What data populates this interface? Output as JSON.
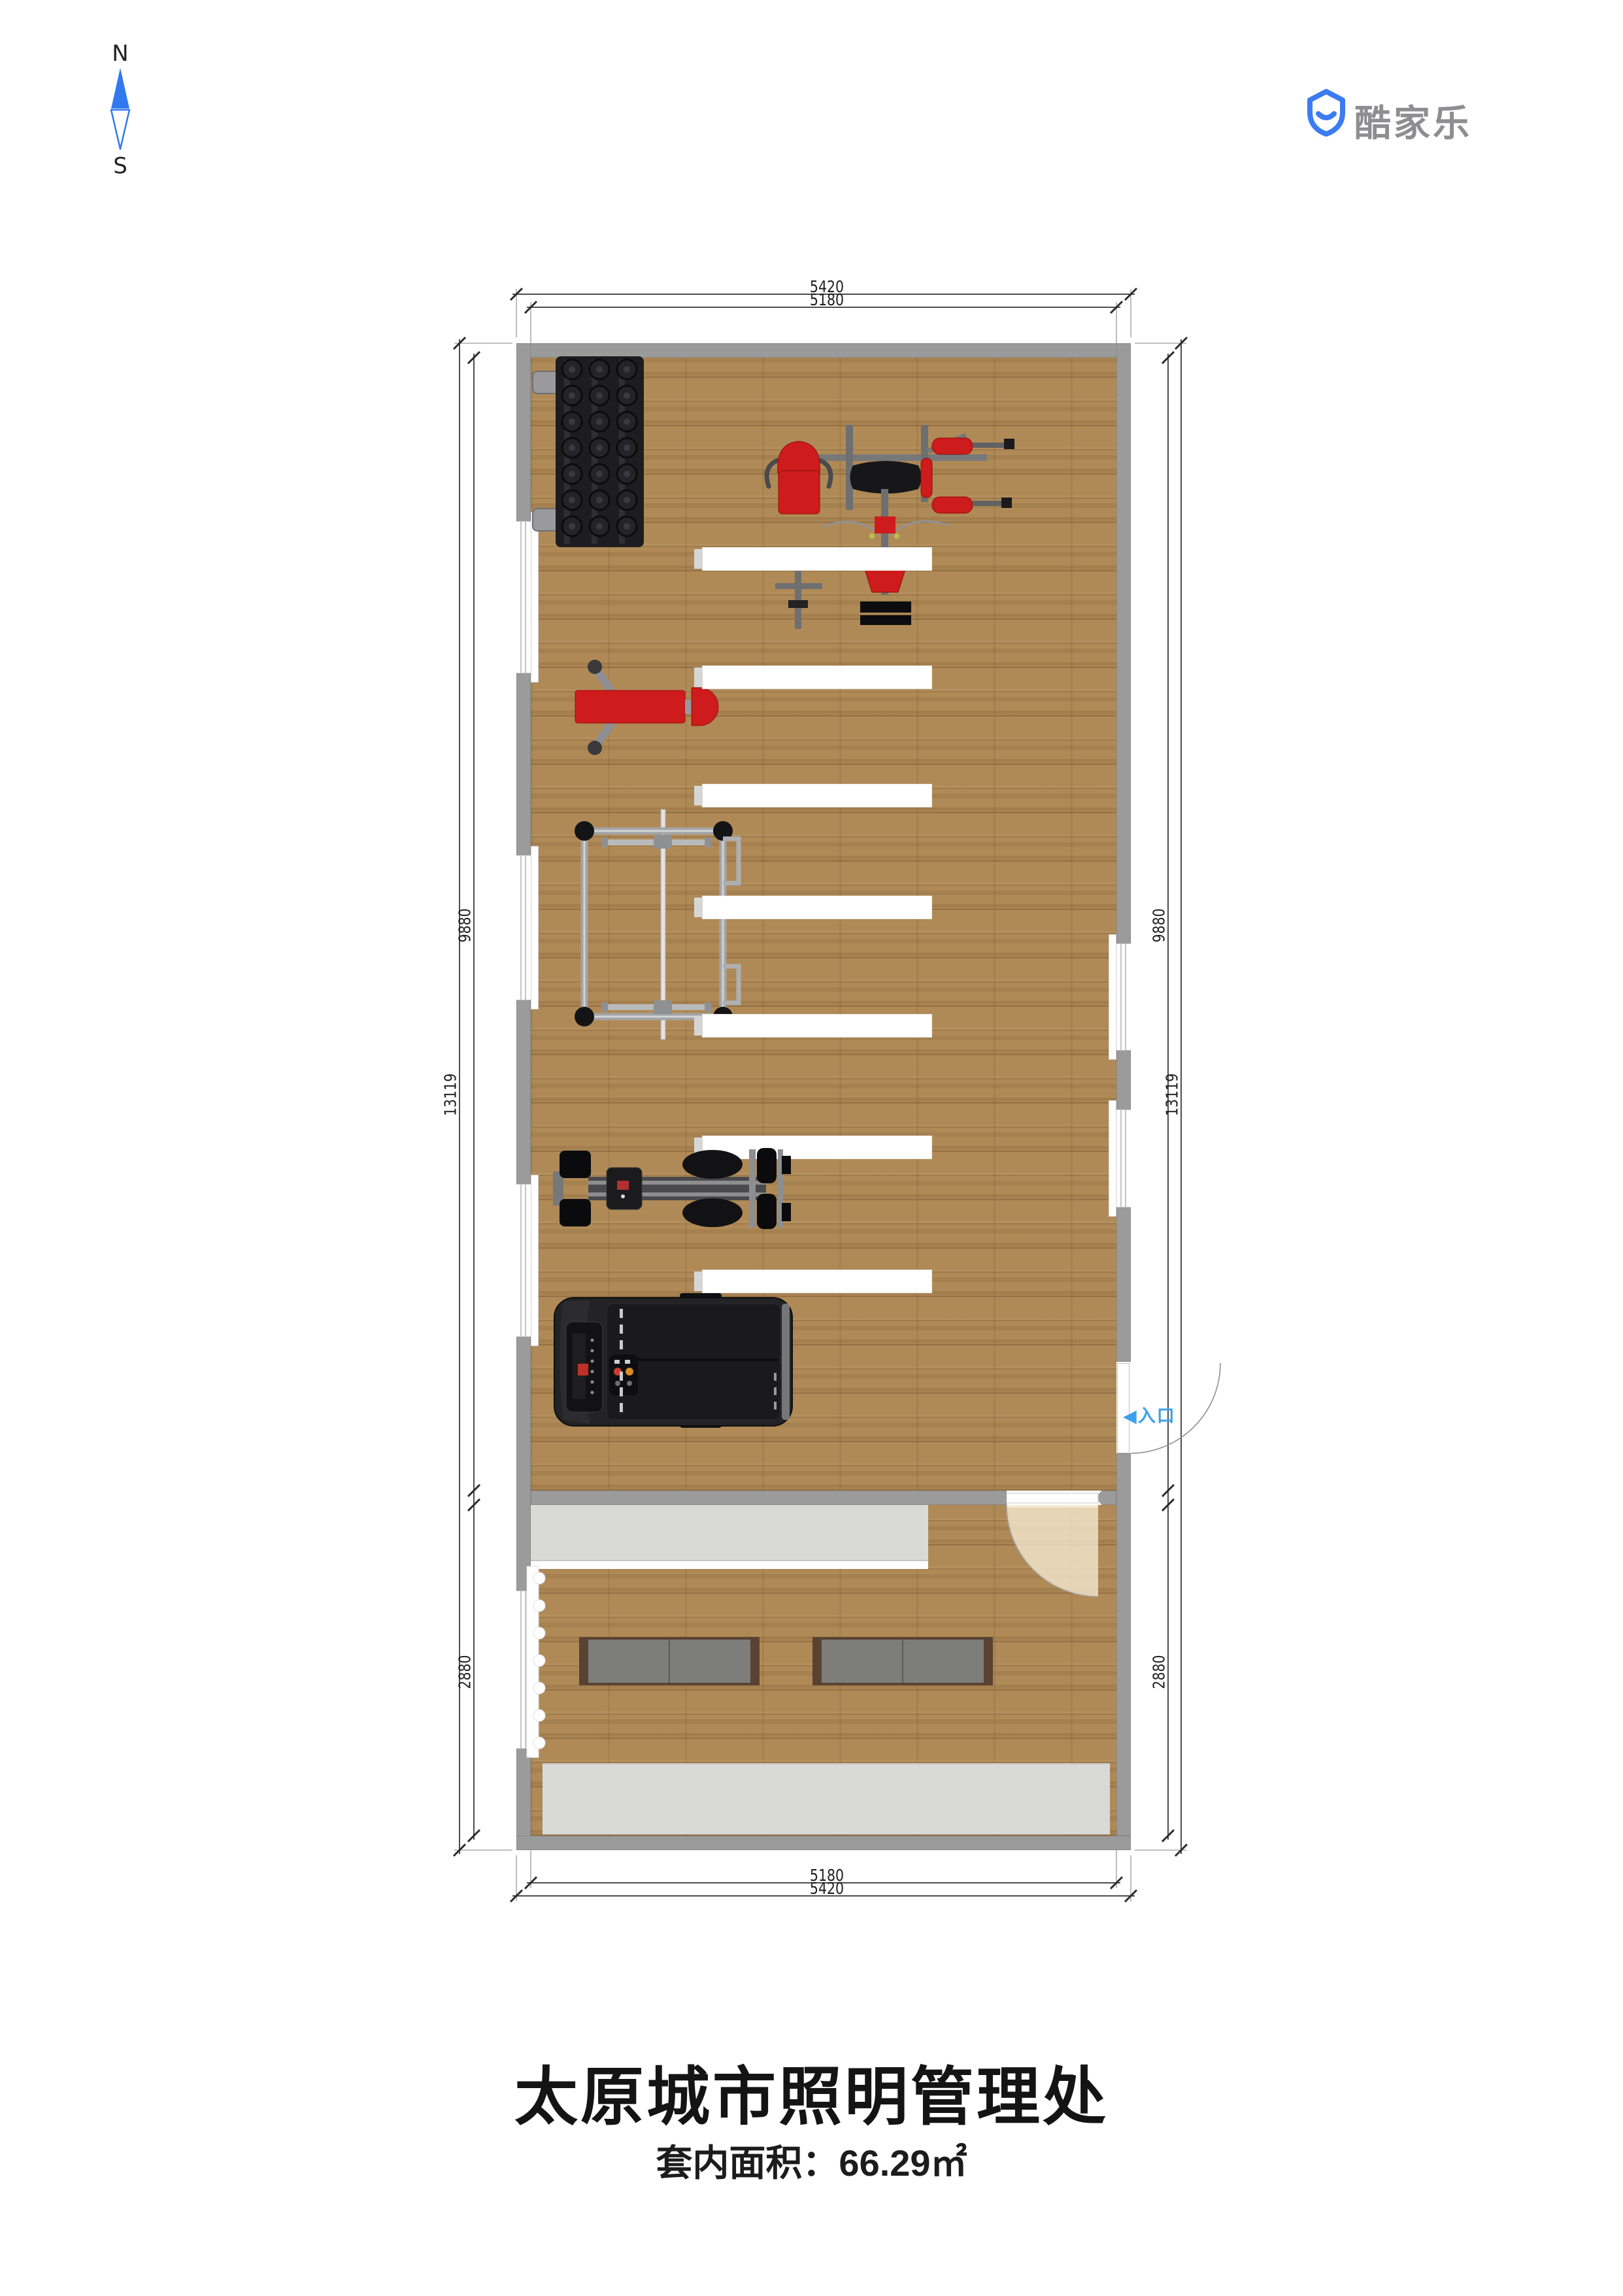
{
  "compass": {
    "north": "N",
    "south": "S"
  },
  "logo": {
    "brand": "酷家乐"
  },
  "dimensions": {
    "top_outer": "5420",
    "top_inner": "5180",
    "bottom_inner": "5180",
    "bottom_outer": "5420",
    "left_outer": "13119",
    "left_upper": "9880",
    "left_lower": "2880",
    "right_outer": "13119",
    "right_upper": "9880",
    "right_lower": "2880"
  },
  "entrance": {
    "arrow": "◀",
    "label": "入口"
  },
  "rooms": {
    "upper": "健身区",
    "lower": "休息区"
  },
  "equipment": [
    "dumbbell-rack",
    "multi-gym-machine",
    "weight-bench",
    "power-rack",
    "exercise-bike",
    "treadmill",
    "counter",
    "locker-bench",
    "radiator",
    "ceiling-light"
  ],
  "footer": {
    "title": "太原城市照明管理处",
    "area": "套内面积：66.29㎡"
  },
  "colors": {
    "wall": "#9b9b9b",
    "floor": "#b08a56",
    "red": "#ce1b1b",
    "counter": "#d9d9d8",
    "benchtop": "#7d7d7b",
    "benchframe": "#5a4233",
    "entryblue": "#3ba1ea",
    "brandblue": "#3b7cf2",
    "brandtext": "#8e8e90",
    "dimline": "#4d4d4d",
    "swing": "#f1e5cc"
  }
}
